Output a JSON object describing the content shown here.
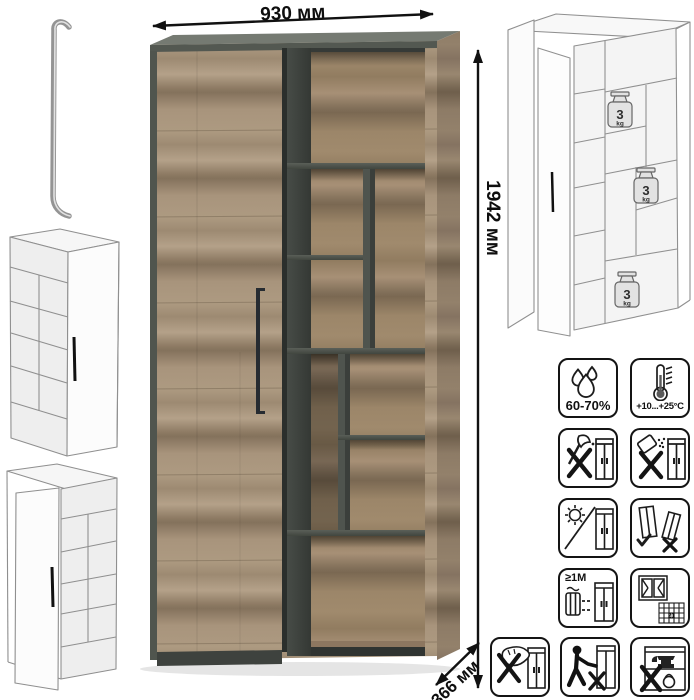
{
  "product": {
    "kind": "two-section cabinet with open shelving",
    "dimensions": {
      "width": "930 мм",
      "height": "1942 мм",
      "depth": "366 мм"
    }
  },
  "load_labels": [
    {
      "value": "3",
      "unit": "kg"
    },
    {
      "value": "3",
      "unit": "kg"
    },
    {
      "value": "3",
      "unit": "kg"
    }
  ],
  "care_icons": [
    {
      "name": "humidity-icon",
      "label": "60-70%"
    },
    {
      "name": "temperature-icon",
      "label": "+10...+25°C"
    },
    {
      "name": "no-axe-impact-icon"
    },
    {
      "name": "no-spill-icon"
    },
    {
      "name": "no-direct-sunlight-icon"
    },
    {
      "name": "carry-upright-icon"
    },
    {
      "name": "heat-distance-icon",
      "label": "≥1M"
    },
    {
      "name": "ventilation-icon",
      "badge": "21"
    },
    {
      "name": "no-wet-cleaning-icon"
    },
    {
      "name": "no-leaning-icon"
    },
    {
      "name": "no-overload-icon"
    }
  ],
  "colors": {
    "wood_light": "#b4a189",
    "wood_mid": "#9d8a72",
    "wood_dark": "#84725c",
    "graphite": "#4f544e",
    "interior_dark": "#363a37",
    "line_art": "#8f8f8f",
    "annotation": "#111111"
  }
}
